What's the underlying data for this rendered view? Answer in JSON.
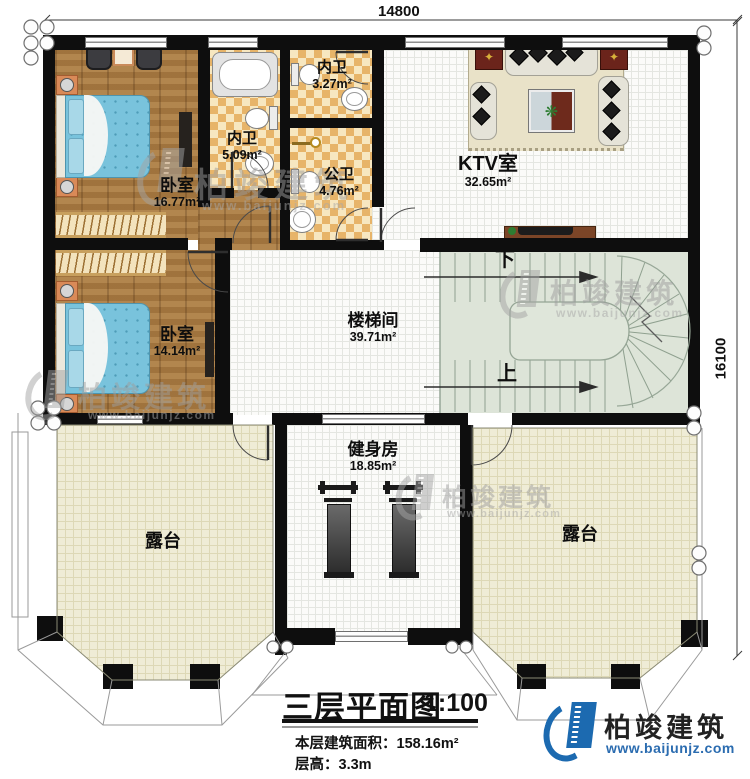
{
  "plan": {
    "dimensions": {
      "width_mm": "14800",
      "height_mm": "16100"
    },
    "rooms": {
      "bedroom1": {
        "name": "卧室",
        "area": "16.77m²"
      },
      "bedroom2": {
        "name": "卧室",
        "area": "14.14m²"
      },
      "bath_inner1": {
        "name": "内卫",
        "area": "5.09m²"
      },
      "bath_inner2": {
        "name": "内卫",
        "area": "3.27m²"
      },
      "bath_public": {
        "name": "公卫",
        "area": "4.76m²"
      },
      "ktv": {
        "name": "KTV室",
        "area": "32.65m²"
      },
      "stairwell": {
        "name": "楼梯间",
        "area": "39.71m²"
      },
      "gym": {
        "name": "健身房",
        "area": "18.85m²"
      },
      "terrace_left": {
        "name": "露台"
      },
      "terrace_right": {
        "name": "露台"
      }
    },
    "stairs": {
      "down": "下",
      "up": "上"
    }
  },
  "titleblock": {
    "title": "三层平面图",
    "scale": "1:100",
    "area_line": "本层建筑面积：158.16m²",
    "height_line": "层高：3.3m"
  },
  "branding": {
    "logo_text": "柏竣建筑",
    "logo_url": "www.baijunjz.com"
  },
  "watermark": {
    "text": "柏竣建筑",
    "url": "www.baijunjz.com"
  },
  "colors": {
    "wall": "#0e0e0e",
    "wood_floor": "#a97b43",
    "bed_blue": "#79c3dc",
    "tile_tan": "#e7b469",
    "terrace": "#efecd6",
    "stair_green": "#dde4d8",
    "brand_blue": "#1c6ab0",
    "url_blue": "#2b6cb0",
    "speaker_red": "#6b241b"
  }
}
